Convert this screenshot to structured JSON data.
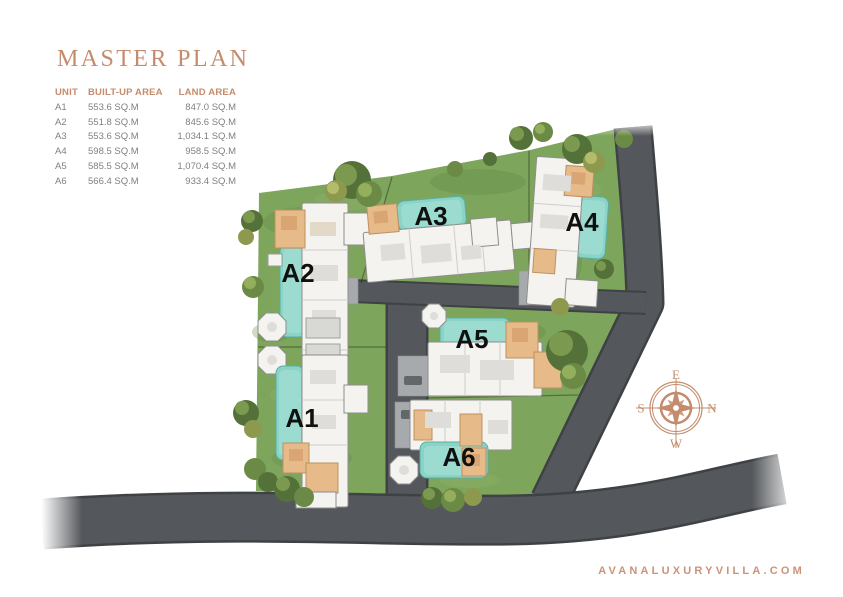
{
  "title": "MASTER PLAN",
  "website": "AVANALUXURYVILLA.COM",
  "table": {
    "headers": [
      "UNIT",
      "BUILT-UP AREA",
      "LAND AREA"
    ],
    "rows": [
      {
        "unit": "A1",
        "built_up": "553.6 SQ.M",
        "land": "847.0 SQ.M"
      },
      {
        "unit": "A2",
        "built_up": "551.8 SQ.M",
        "land": "845.6 SQ.M"
      },
      {
        "unit": "A3",
        "built_up": "553.6 SQ.M",
        "land": "1,034.1 SQ.M"
      },
      {
        "unit": "A4",
        "built_up": "598.5 SQ.M",
        "land": "958.5 SQ.M"
      },
      {
        "unit": "A5",
        "built_up": "585.5 SQ.M",
        "land": "1,070.4 SQ.M"
      },
      {
        "unit": "A6",
        "built_up": "566.4 SQ.M",
        "land": "933.4 SQ.M"
      }
    ]
  },
  "units": [
    {
      "label": "A1"
    },
    {
      "label": "A2"
    },
    {
      "label": "A3"
    },
    {
      "label": "A4"
    },
    {
      "label": "A5"
    },
    {
      "label": "A6"
    }
  ],
  "compass": {
    "top": "E",
    "right": "N",
    "bottom": "W",
    "left": "S"
  },
  "colors": {
    "accent_copper": "#C48C6C",
    "website_copper": "#CA9379",
    "table_text_gray": "#7E8083",
    "unit_label_black": "#101010",
    "road_gray": "#54575B",
    "grass_green": "#7EA55C",
    "pool_teal": "#8BD3C7",
    "driveway_gray": "#A7AAAC",
    "building_white": "#F4F3F0",
    "room_tan": "#E6BA89"
  }
}
